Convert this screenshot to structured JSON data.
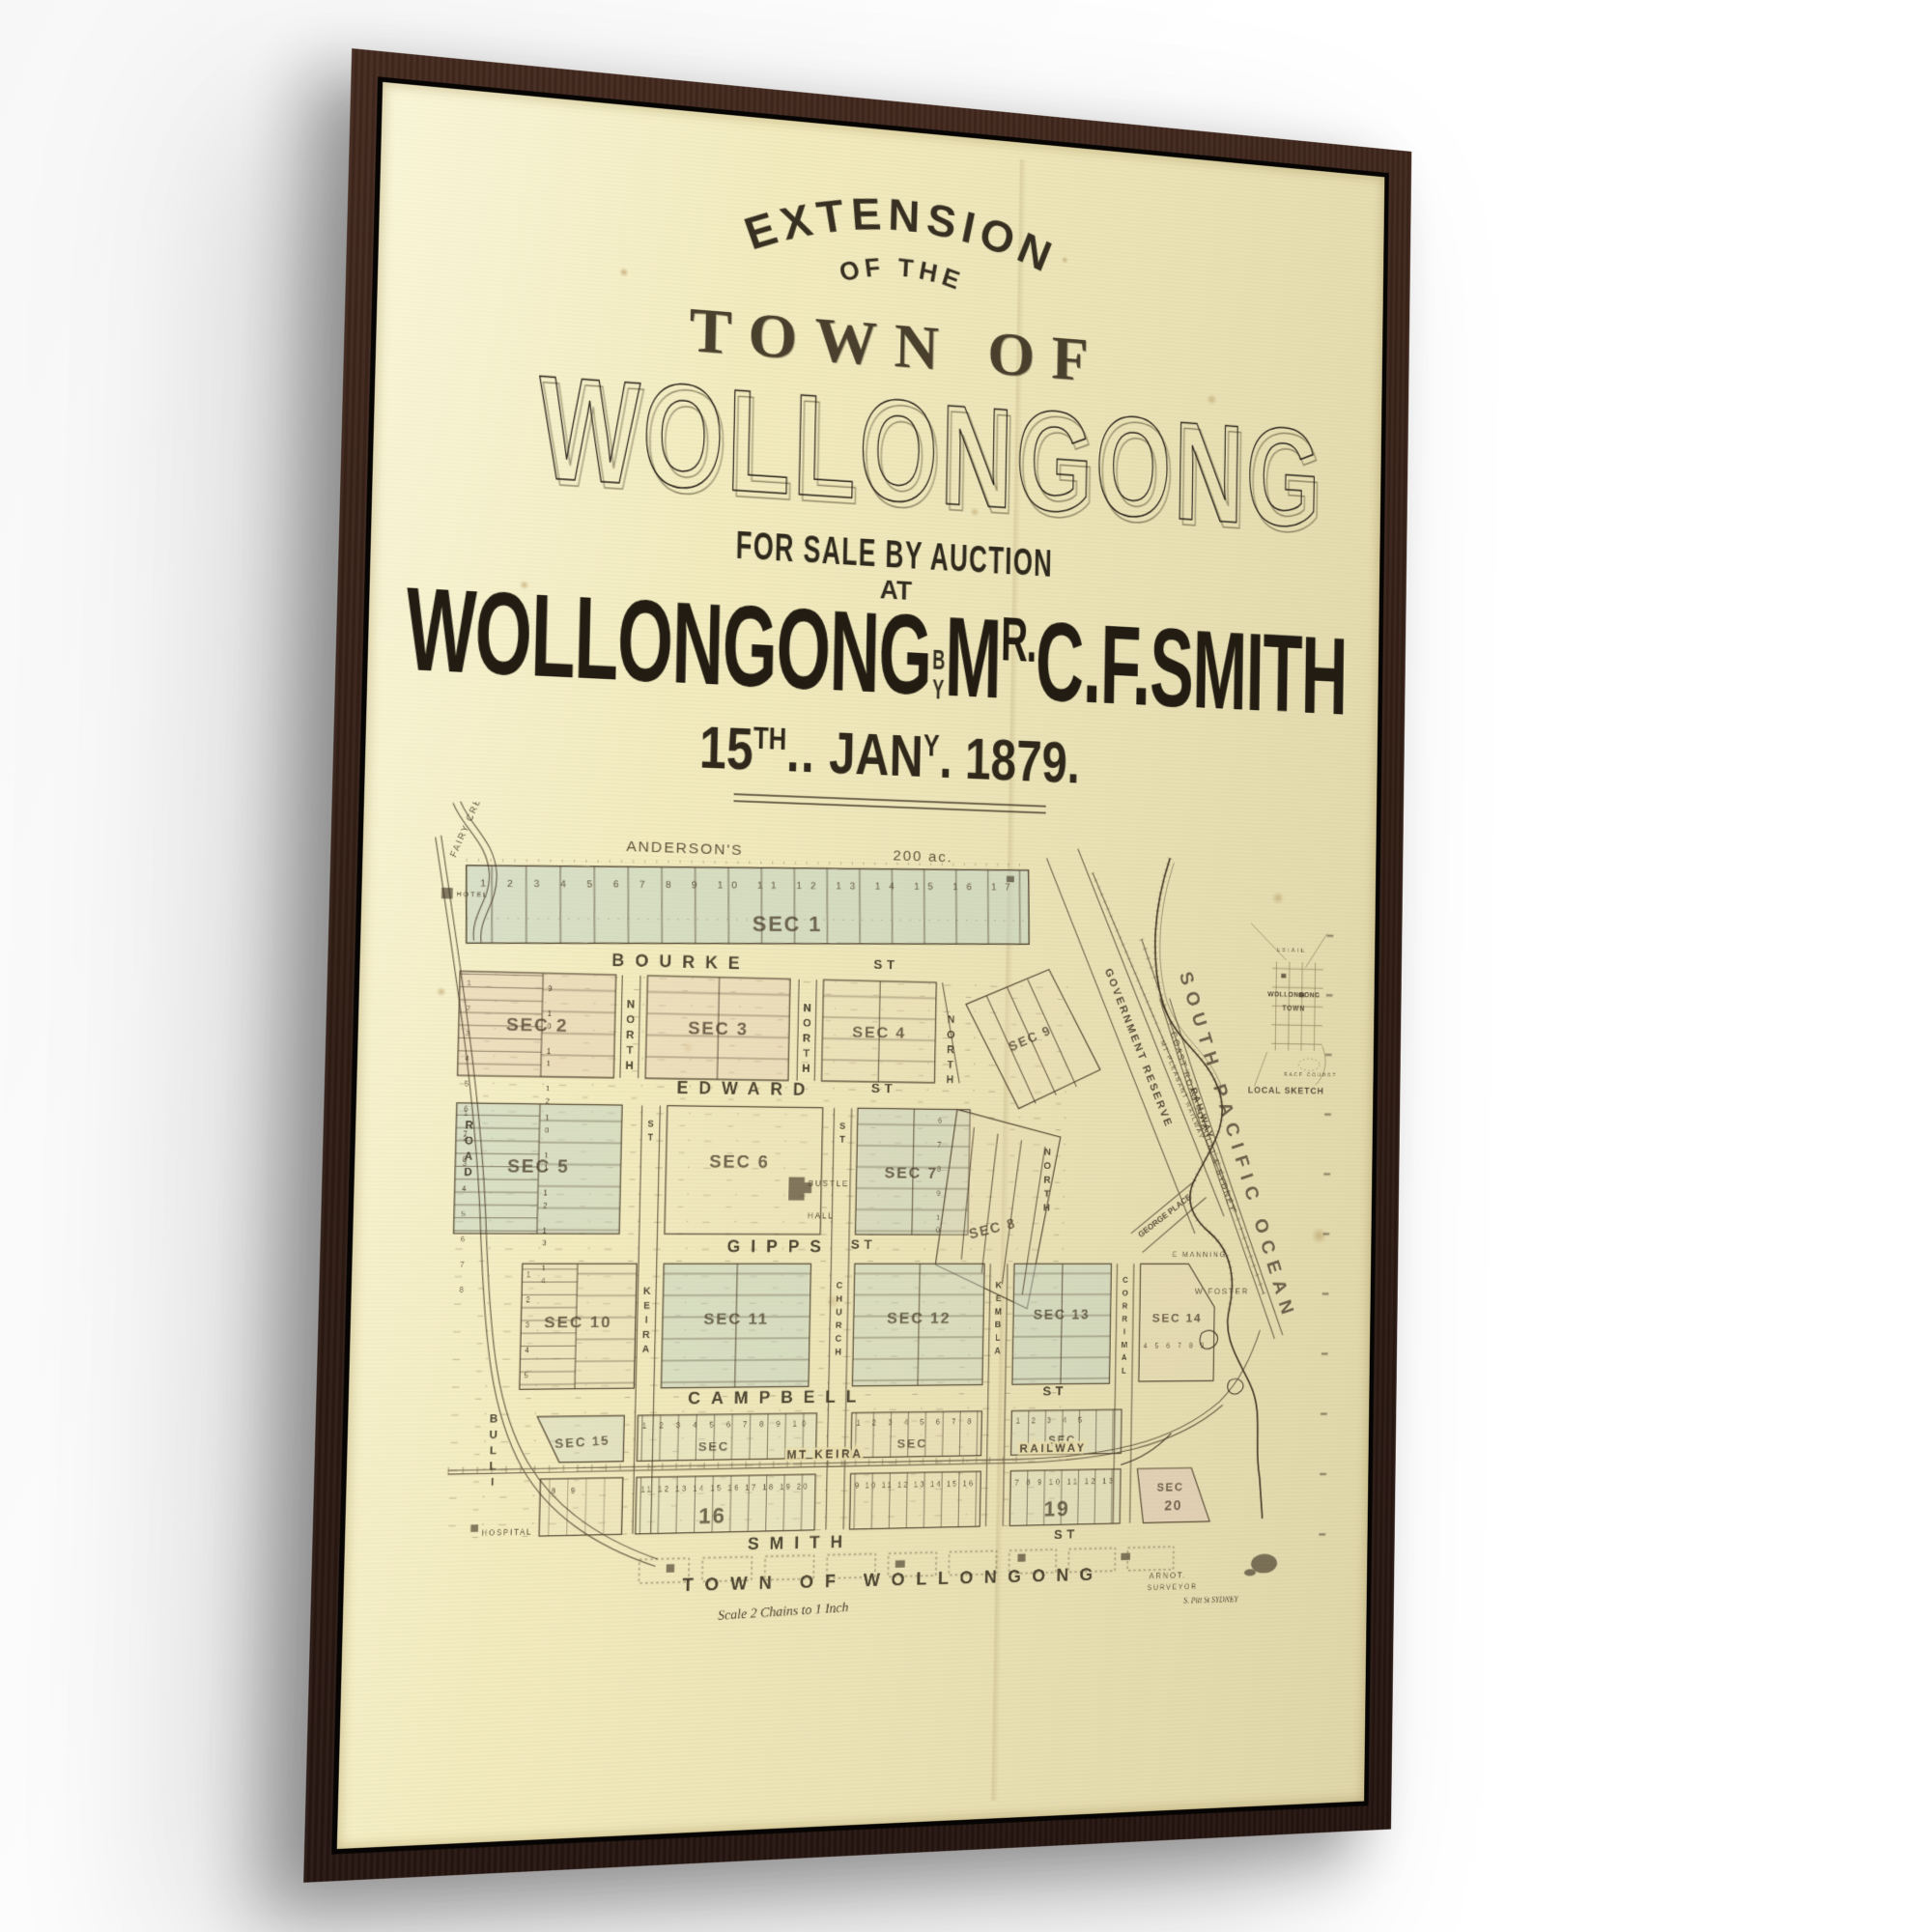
{
  "colors": {
    "frame": "#31201a",
    "canvas": "#f3ecc0",
    "paper": "#e8daa9",
    "ink": "#3a3125",
    "block_blue": "#bccfc4",
    "block_pink": "#dfc3ad"
  },
  "poster": {
    "header": {
      "arch_title": "EXTENSION",
      "arch_sub": "OF THE",
      "town_of": "TOWN OF",
      "big_title": "WOLLONGONG",
      "sale_line": "FOR SALE BY AUCTION",
      "at": "AT",
      "auction_left": "WOLLONGONG",
      "auction_by": "BY",
      "agent_m": "M",
      "agent_sup": "R.",
      "agent_rest": "C.F.SMITH",
      "date": {
        "day": "15",
        "day_sup": "TH",
        "day_dots": "..",
        "month": "JAN",
        "month_sup": "Y",
        "month_dot": ".",
        "year": "1879."
      }
    }
  },
  "map": {
    "anderson": "ANDERSON'S",
    "area": "200 ac.",
    "creek": "FAIRY CREEK",
    "hotel": "HOTEL",
    "road": "ROAD",
    "bulli": "BULLI",
    "hospital": "HOSPITAL",
    "streets": {
      "bourke": "BOURKE",
      "edward": "EDWARD",
      "gipps": "GIPPS",
      "campbell": "CAMPBELL",
      "smith": "SMITH",
      "st": "ST"
    },
    "vstreets": {
      "keira": "KEIRA",
      "church": "CHURCH",
      "kembla": "KEMBLA",
      "corrimal": "CORRIMAL",
      "north": "NORTH",
      "st": "ST"
    },
    "sections": {
      "s1": "SEC 1",
      "s2": "SEC 2",
      "s3": "SEC 3",
      "s4": "SEC 4",
      "s5": "SEC 5",
      "s6": "SEC 6",
      "s7": "SEC 7",
      "s8": "SEC 8",
      "s9": "SEC 9",
      "s10": "SEC 10",
      "s11": "SEC 11",
      "s12": "SEC 12",
      "s13": "SEC 13",
      "s14": "SEC 14",
      "s15": "SEC 15",
      "s16": "SEC",
      "s17": "SEC",
      "s18": "SEC",
      "s20_label": "SEC",
      "s20_num": "20",
      "big16": "16",
      "big19": "19"
    },
    "lots": {
      "sec1": "1 2 3 4 5 6 7 8 9 10 11 12 13 14 15 16 17",
      "n1_8": "1 2 3 4 5 6 7 8",
      "n9_12": "9 10 11 12",
      "n10_14": "10 11 12 13 14",
      "n6_10": "6 7 8 9 10",
      "n1_5": "1 2 3 4 5",
      "n1_10": "1 2 3 4 5 6 7 8 9 10",
      "n11_20": "11 12 13 14 15 16 17 18 19 20",
      "n9_16": "9 10 11 12 13 14 15 16",
      "n7_13": "7 8 9 10 11 12 13",
      "n4_9": "4 5 6 7 8 9",
      "n8_9": "8 9"
    },
    "features": {
      "reserve": "GOVERNMENT RESERVE",
      "mt_pleasant": "MT PLEASANT RAILWAY",
      "railway": "RAILWAY",
      "coast_road": "COAST ROAD TO BULLI & SYDNEY",
      "george": "GEORGE PLACE",
      "manning": "E MANNING",
      "foster": "W FOSTER",
      "mt_keira": "MT KEIRA",
      "railway2": "RAILWAY",
      "ocean": "SOUTH PACIFIC OCEAN",
      "bustle": "BUSTLE",
      "hall": "HALL"
    },
    "inset": {
      "estate": "ESTATE",
      "town1": "WOLLONGONG",
      "town2": "TOWN",
      "race": "RACE COURSE",
      "caption": "LOCAL SKETCH"
    },
    "footer": {
      "town_line": "TOWN OF WOLLONGONG",
      "scale": "Scale 2 Chains to 1 Inch",
      "sig1": "ARNOT.",
      "sig2": "SURVEYOR",
      "sig3": "S. Pitt St SYDNEY"
    }
  }
}
